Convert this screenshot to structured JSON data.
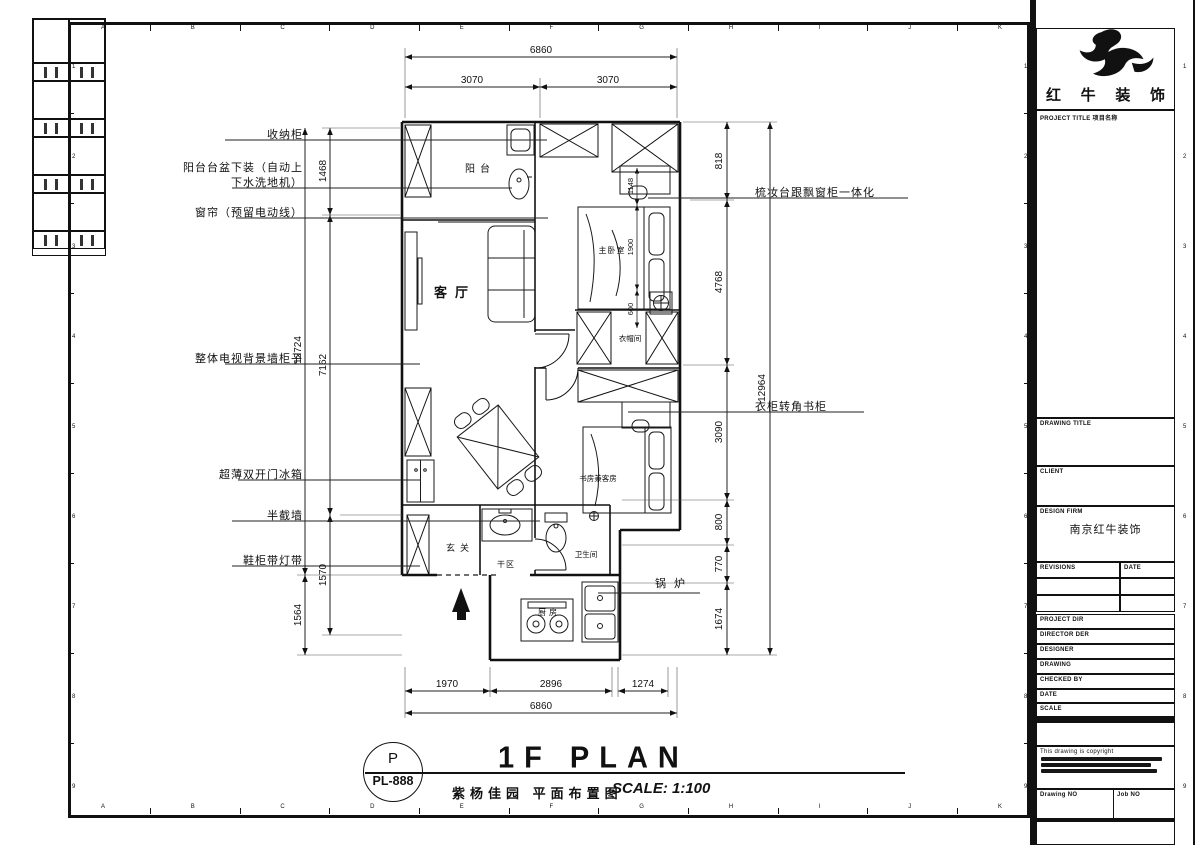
{
  "sheet": {
    "cols": [
      "A",
      "B",
      "C",
      "D",
      "E",
      "F",
      "G",
      "H",
      "I",
      "J",
      "K"
    ],
    "rows": [
      "1",
      "2",
      "3",
      "4",
      "5",
      "6",
      "7",
      "8",
      "9"
    ]
  },
  "plan": {
    "rooms": {
      "balcony": "阳台",
      "living": "客厅",
      "master": "主卧室",
      "cloak": "衣帽间",
      "study": "书房兼客房",
      "dry": "干区",
      "bath": "卫生间",
      "foyer": "玄关",
      "kitchen": "厨房",
      "boiler": "锅炉"
    },
    "callouts_left": [
      {
        "line1": "收纳柜"
      },
      {
        "line1": "阳台台盆下装（自动上",
        "line2": "下水洗地机）"
      },
      {
        "line1": "窗帘（预留电动线）"
      },
      {
        "line1": "整体电视背景墙柜子"
      },
      {
        "line1": "超薄双开门冰箱"
      },
      {
        "line1": "半截墙"
      },
      {
        "line1": "鞋柜带灯带"
      }
    ],
    "callouts_right": [
      {
        "line1": "梳妆台跟飘窗柜一体化"
      },
      {
        "line1": "衣柜转角书柜"
      }
    ],
    "dims": {
      "top_total": "6860",
      "top_left": "3070",
      "top_right": "3070",
      "bottom_1": "1970",
      "bottom_2": "2896",
      "bottom_3": "1274",
      "bottom_total": "6860",
      "left_1": "1468",
      "left_2": "7162",
      "left_3": "1570",
      "left_total": "12724",
      "left_4": "1564",
      "right_1": "818",
      "right_2": "4768",
      "right_3": "3090",
      "right_4": "800",
      "right_5": "770",
      "right_6": "1674",
      "right_total": "12964",
      "bed_1": "1148",
      "bed_2": "1900",
      "bed_3": "600"
    }
  },
  "footer": {
    "tag_top": "P",
    "tag_no": "PL-888",
    "title": "1F PLAN",
    "subtitle": "紫杨佳园 平面布置图",
    "scale": "SCALE: 1:100"
  },
  "titleblock": {
    "company": "红牛装饰",
    "project_title": "PROJECT TITLE  项目名称",
    "drawing_title": "DRAWING TITLE",
    "client": "CLIENT",
    "design_firm": "DESIGN FIRM",
    "design_firm_value": "南京红牛装饰",
    "revisions": "REVISIONS",
    "date_col": "DATE",
    "field_rows": [
      "PROJECT DIR",
      "DIRECTOR DER",
      "DESIGNER",
      "DRAWING",
      "CHECKED BY",
      "DATE",
      "SCALE"
    ],
    "copyright": "This drawing is copyright",
    "drawing_no": "Drawing NO",
    "job_no": "Job NO"
  }
}
